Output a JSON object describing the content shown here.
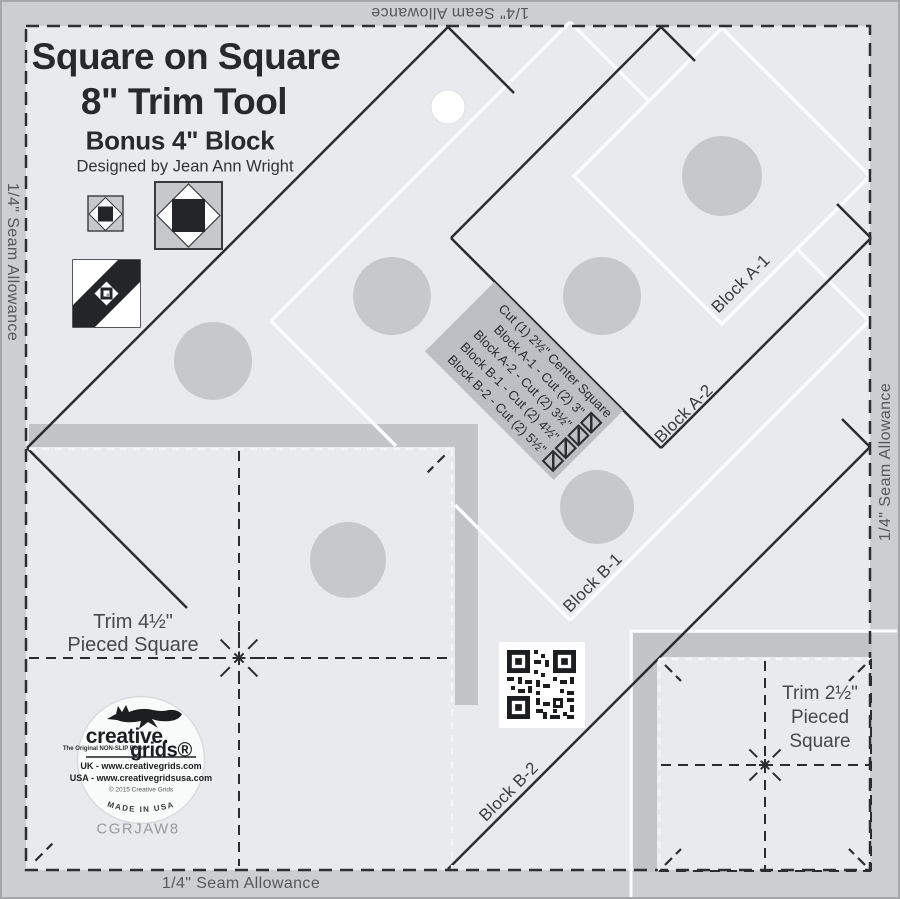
{
  "header": {
    "title_line1": "Square on Square",
    "title_line2": "8\" Trim Tool",
    "title_line3": "Bonus 4\" Block",
    "byline": "Designed by Jean Ann Wright"
  },
  "labels": {
    "seam_allowance": "1/4\" Seam Allowance"
  },
  "cut_panel": {
    "header": "Cut (1) 2½\" Center Square",
    "rows": [
      {
        "label": "Block A-1 - Cut (2) 3\""
      },
      {
        "label": "Block A-2 - Cut (2) 3½\""
      },
      {
        "label": "Block B-1 - Cut (2) 4½\""
      },
      {
        "label": "Block B-2 - Cut (2) 5½\""
      }
    ]
  },
  "block_labels": {
    "a1": "Block A-1",
    "a2": "Block A-2",
    "b1": "Block B-1",
    "b2": "Block B-2"
  },
  "trim_large": {
    "line1": "Trim 4½\"",
    "line2": "Pieced Square"
  },
  "trim_small": {
    "line1": "Trim 2½\"",
    "line2": "Pieced",
    "line3": "Square"
  },
  "logo": {
    "brand_top": "creative.",
    "brand_bottom": "grids®",
    "tagline": "The Original NON-SLIP Ruler",
    "uk_line": "UK - www.creativegrids.com",
    "usa_line": "USA - www.creativegridsusa.com",
    "copyright": "© 2015 Creative Grids",
    "made_in": "MADE IN USA"
  },
  "product_code": "CGRJAW8",
  "colors": {
    "body": "#e8eaed",
    "seam_band": "#ccced1",
    "trim_band": "#c2c5c8",
    "grip_dot": "#c6c9cc",
    "line_dark": "#2b2c2e",
    "line_white": "#fafbfc",
    "panel_bg": "#bcbfc3"
  }
}
